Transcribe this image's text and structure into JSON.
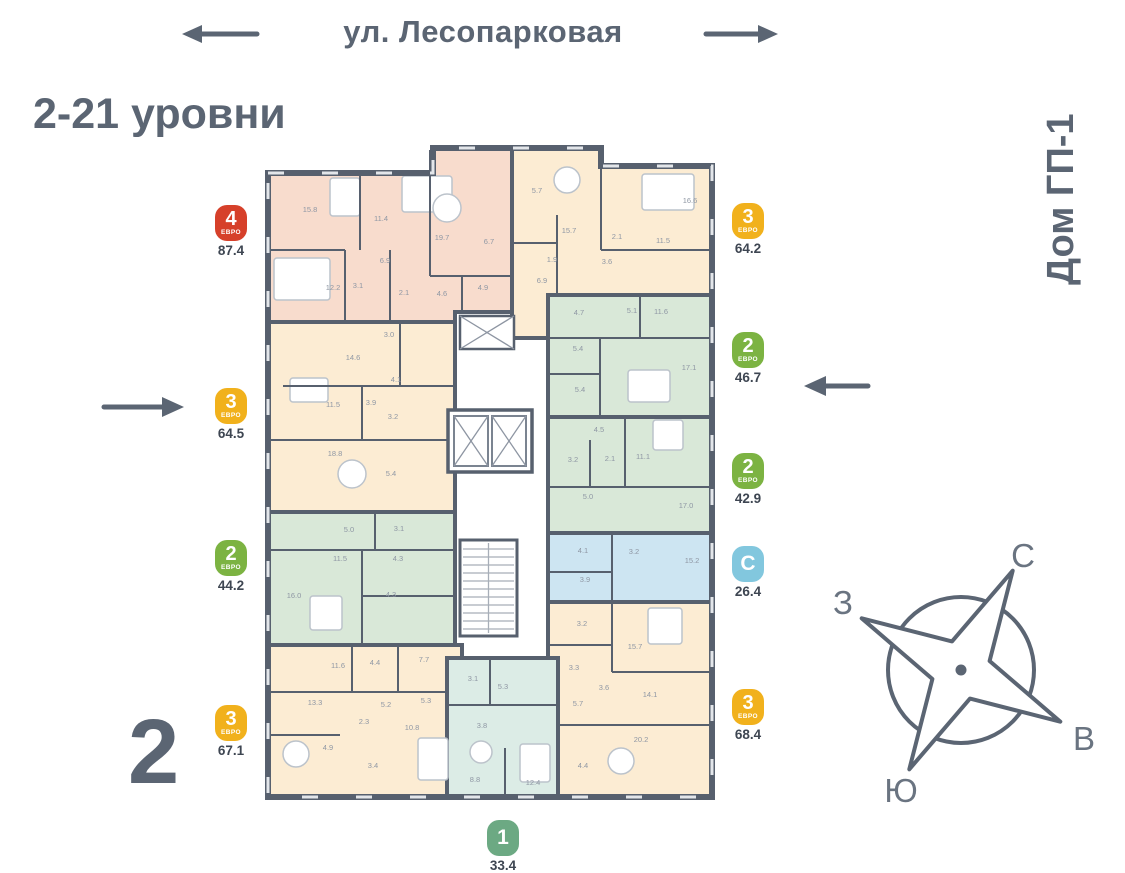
{
  "header": {
    "street": "ул. Лесопарковая",
    "levels": "2-21 уровни",
    "building": "Дом ГП-1",
    "floor_number": "2"
  },
  "compass": {
    "north": "С",
    "south": "Ю",
    "west": "З",
    "east": "В"
  },
  "plan": {
    "wall_color": "#57606e",
    "window_color": "#e3e6ea",
    "label_color": "#8f97a4",
    "apartments": [
      {
        "id": "a1",
        "badge": {
          "num": "4",
          "sub": "ЕВРО",
          "color": "#d6402a"
        },
        "area": "87.4",
        "fill": "#f8dccd",
        "rooms": [
          "15.8",
          "11.4",
          "19.7",
          "6.7",
          "6.9",
          "12.2",
          "3.1",
          "2.1",
          "4.6",
          "4.9"
        ]
      },
      {
        "id": "a2",
        "badge": {
          "num": "3",
          "sub": "ЕВРО",
          "color": "#f1b11c"
        },
        "area": "64.5",
        "fill": "#fcecd3",
        "rooms": [
          "14.6",
          "3.0",
          "4.1",
          "11.5",
          "3.9",
          "3.2",
          "18.8",
          "5.4"
        ]
      },
      {
        "id": "a3",
        "badge": {
          "num": "2",
          "sub": "ЕВРО",
          "color": "#7cb342"
        },
        "area": "44.2",
        "fill": "#d9e8d8",
        "rooms": [
          "5.0",
          "3.1",
          "11.5",
          "4.3",
          "16.0",
          "4.3"
        ]
      },
      {
        "id": "a4",
        "badge": {
          "num": "3",
          "sub": "ЕВРО",
          "color": "#f1b11c"
        },
        "area": "67.1",
        "fill": "#fcecd3",
        "rooms": [
          "11.6",
          "4.4",
          "7.7",
          "13.3",
          "5.2",
          "2.3",
          "5.3",
          "10.8",
          "4.9",
          "3.4"
        ]
      },
      {
        "id": "b1",
        "badge": {
          "num": "3",
          "sub": "ЕВРО",
          "color": "#f1b11c"
        },
        "area": "64.2",
        "fill": "#fcecd3",
        "rooms": [
          "5.7",
          "15.7",
          "16.6",
          "2.1",
          "11.5",
          "1.9",
          "3.6",
          "6.9"
        ]
      },
      {
        "id": "b2",
        "badge": {
          "num": "2",
          "sub": "ЕВРО",
          "color": "#7cb342"
        },
        "area": "46.7",
        "fill": "#d9e8d8",
        "rooms": [
          "4.7",
          "5.1",
          "11.6",
          "5.4",
          "5.4",
          "17.1"
        ]
      },
      {
        "id": "b3",
        "badge": {
          "num": "2",
          "sub": "ЕВРО",
          "color": "#7cb342"
        },
        "area": "42.9",
        "fill": "#d9e8d8",
        "rooms": [
          "4.5",
          "3.2",
          "2.1",
          "11.1",
          "5.0",
          "17.0"
        ]
      },
      {
        "id": "b4",
        "badge": {
          "num": "С",
          "sub": "",
          "color": "#82c7de"
        },
        "area": "26.4",
        "fill": "#cde5f2",
        "rooms": [
          "4.1",
          "3.2",
          "15.2",
          "3.9"
        ]
      },
      {
        "id": "b5",
        "badge": {
          "num": "3",
          "sub": "ЕВРО",
          "color": "#f1b11c"
        },
        "area": "68.4",
        "fill": "#fcecd3",
        "rooms": [
          "3.2",
          "15.7",
          "3.3",
          "3.6",
          "5.7",
          "14.1",
          "20.2",
          "4.4"
        ]
      },
      {
        "id": "c1",
        "badge": {
          "num": "1",
          "sub": "",
          "color": "#6ca983"
        },
        "area": "33.4",
        "fill": "#dcece6",
        "rooms": [
          "3.1",
          "5.3",
          "3.8",
          "8.8",
          "12.4"
        ]
      }
    ]
  }
}
